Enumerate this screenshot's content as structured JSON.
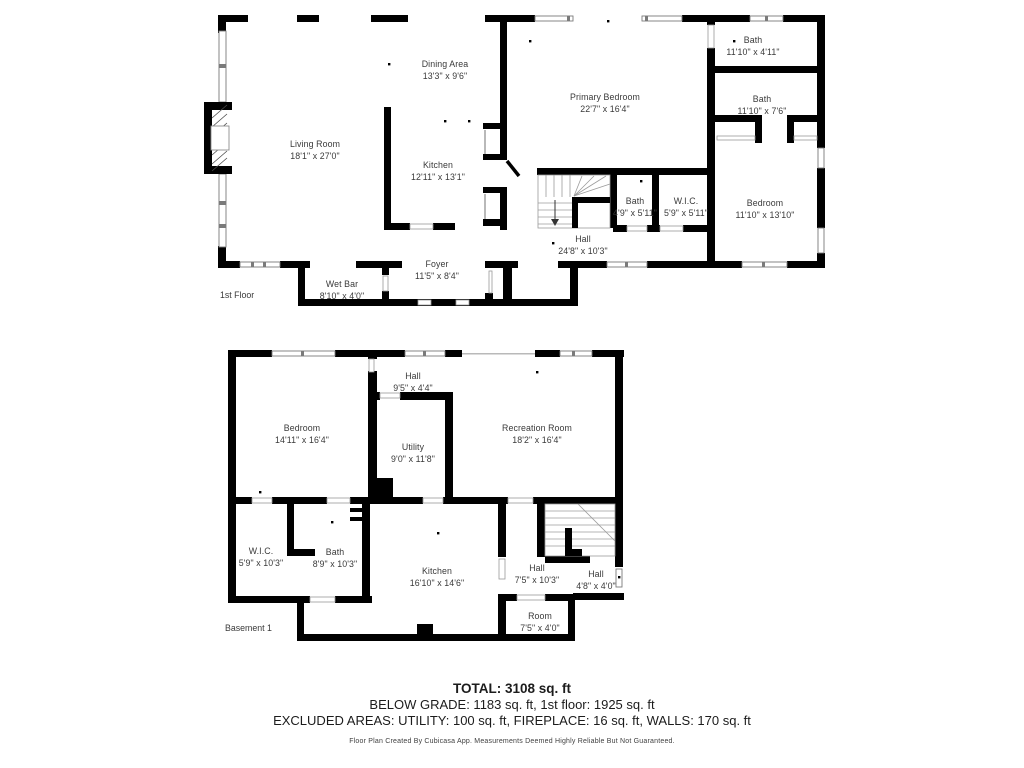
{
  "floor1": {
    "label": "1st Floor",
    "rooms": [
      {
        "name": "Living Room",
        "dims": "18'1\" x 27'0\""
      },
      {
        "name": "Dining Area",
        "dims": "13'3\" x 9'6\""
      },
      {
        "name": "Kitchen",
        "dims": "12'11\" x 13'1\""
      },
      {
        "name": "Primary Bedroom",
        "dims": "22'7\" x 16'4\""
      },
      {
        "name": "Bath",
        "dims": "11'10\" x 4'11\""
      },
      {
        "name": "Bath",
        "dims": "11'10\" x 7'6\""
      },
      {
        "name": "Bath",
        "dims": "4'9\" x 5'11\""
      },
      {
        "name": "W.I.C.",
        "dims": "5'9\" x 5'11\""
      },
      {
        "name": "Bedroom",
        "dims": "11'10\" x 13'10\""
      },
      {
        "name": "Hall",
        "dims": "24'8\" x 10'3\""
      },
      {
        "name": "Foyer",
        "dims": "11'5\" x 8'4\""
      },
      {
        "name": "Wet Bar",
        "dims": "8'10\" x 4'0\""
      }
    ]
  },
  "basement": {
    "label": "Basement 1",
    "rooms": [
      {
        "name": "Hall",
        "dims": "9'5\" x 4'4\""
      },
      {
        "name": "Bedroom",
        "dims": "14'11\" x 16'4\""
      },
      {
        "name": "Utility",
        "dims": "9'0\" x 11'8\""
      },
      {
        "name": "Recreation Room",
        "dims": "18'2\" x 16'4\""
      },
      {
        "name": "W.I.C.",
        "dims": "5'9\" x 10'3\""
      },
      {
        "name": "Bath",
        "dims": "8'9\" x 10'3\""
      },
      {
        "name": "Kitchen",
        "dims": "16'10\" x 14'6\""
      },
      {
        "name": "Hall",
        "dims": "7'5\" x 10'3\""
      },
      {
        "name": "Hall",
        "dims": "4'8\" x 4'0\""
      },
      {
        "name": "Room",
        "dims": "7'5\" x 4'0\""
      }
    ]
  },
  "summary": {
    "total": "TOTAL: 3108 sq. ft",
    "grade_line": "BELOW GRADE: 1183 sq. ft, 1st floor: 1925 sq. ft",
    "excluded_line": "EXCLUDED AREAS: UTILITY: 100 sq. ft, FIREPLACE: 16 sq. ft, WALLS: 170 sq. ft",
    "disclaimer": "Floor Plan Created By Cubicasa App. Measurements Deemed Highly Reliable But Not Guaranteed."
  },
  "colors": {
    "wall": "#000000",
    "label": "#3a3a3a",
    "summary_text": "#1c1c1c"
  }
}
